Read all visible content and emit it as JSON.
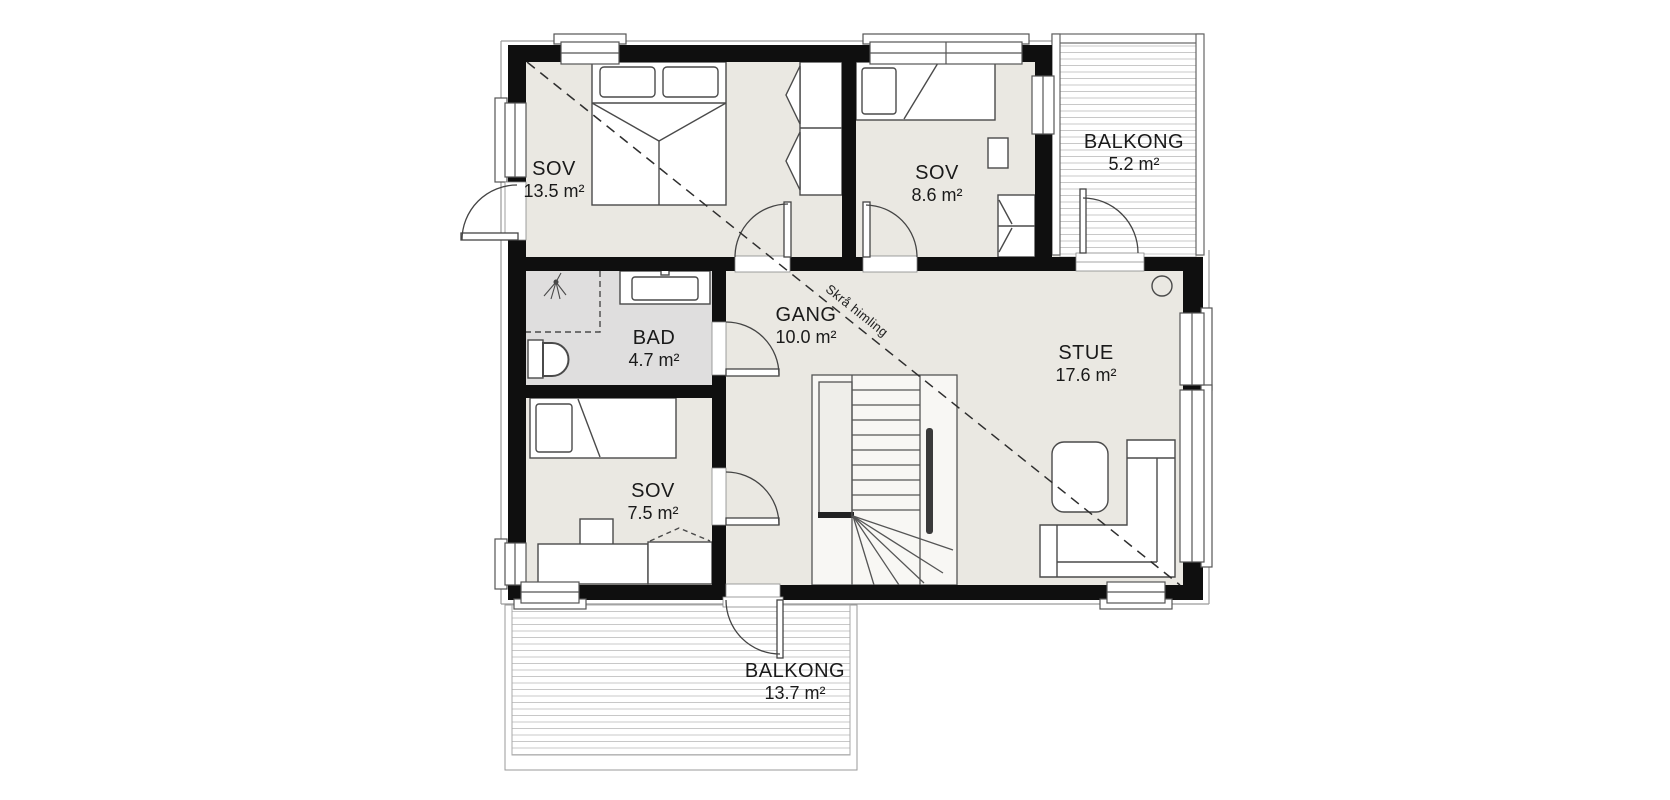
{
  "plan": {
    "rooms": [
      {
        "id": "sov-1",
        "name": "SOV",
        "area": "13.5 m²"
      },
      {
        "id": "sov-2",
        "name": "SOV",
        "area": "8.6 m²"
      },
      {
        "id": "balkong-1",
        "name": "BALKONG",
        "area": "5.2 m²"
      },
      {
        "id": "bad",
        "name": "BAD",
        "area": "4.7 m²"
      },
      {
        "id": "gang",
        "name": "GANG",
        "area": "10.0 m²"
      },
      {
        "id": "stue",
        "name": "STUE",
        "area": "17.6 m²"
      },
      {
        "id": "sov-3",
        "name": "SOV",
        "area": "7.5 m²"
      },
      {
        "id": "balkong-2",
        "name": "BALKONG",
        "area": "13.7 m²"
      }
    ],
    "annotations": {
      "sloped_ceiling": "Skrå himling"
    },
    "colors": {
      "wall": "#0f0f0f",
      "floor": "#eae8e2",
      "bathroom_floor": "#dfdede",
      "deck_line": "#c8c8c8",
      "furniture_line": "#4a4a4a"
    }
  }
}
